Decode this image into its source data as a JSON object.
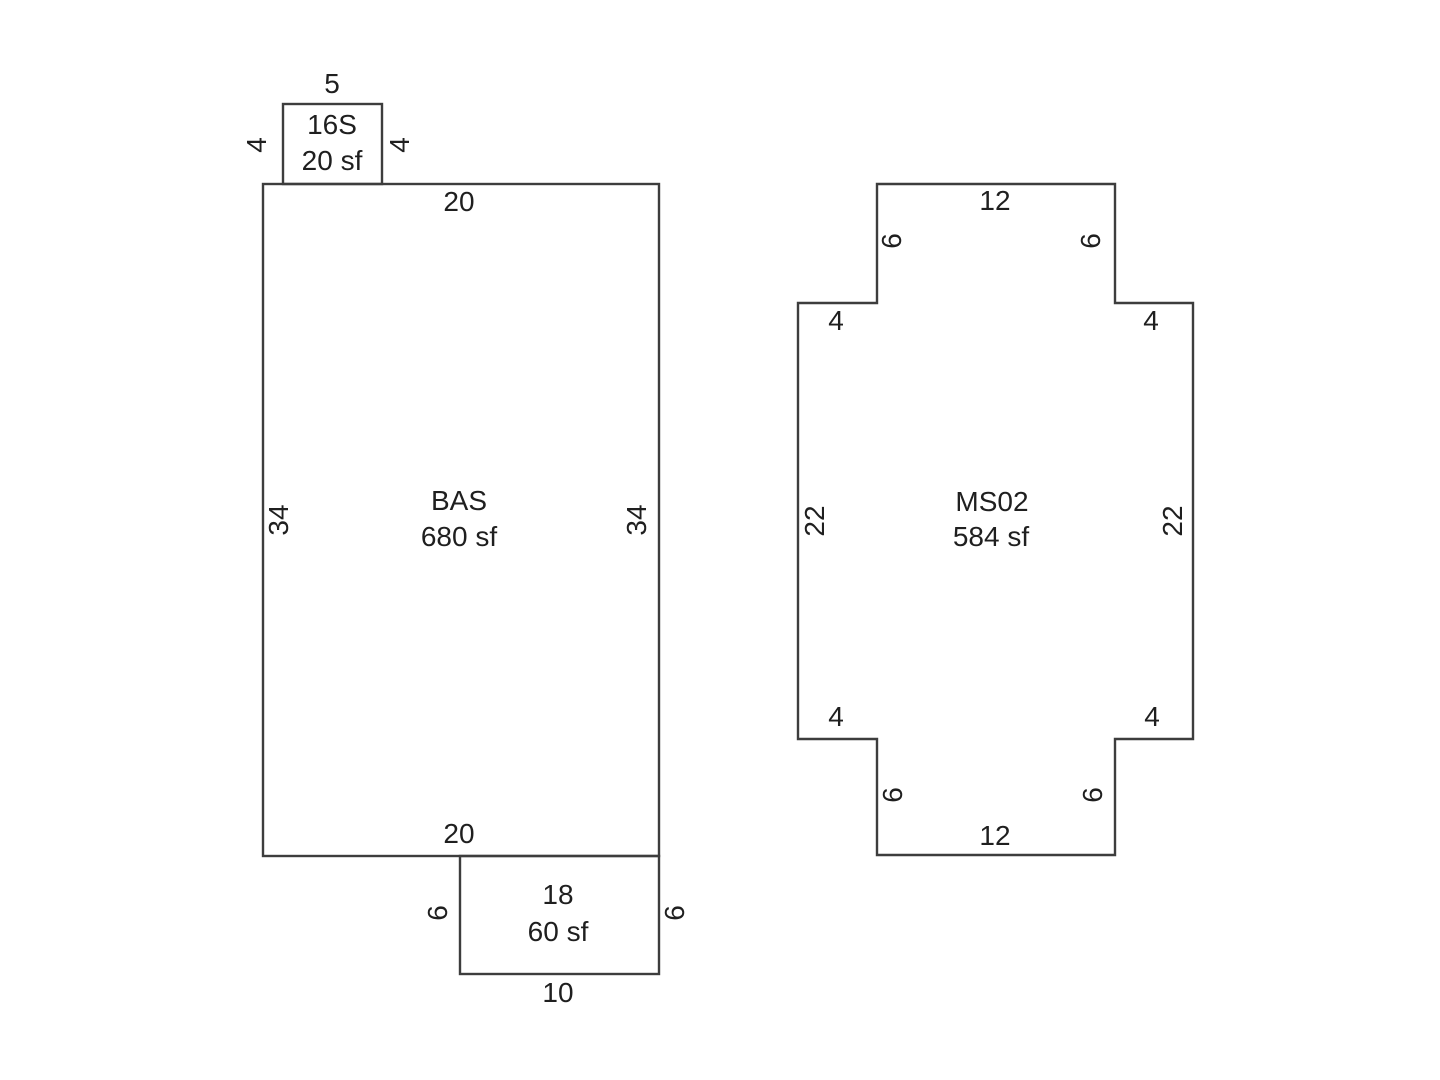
{
  "style": {
    "line_color": "#3d3d3d",
    "text_color": "#1f1f1f",
    "background": "#ffffff"
  },
  "figures": {
    "left": {
      "addition": {
        "name": "16S",
        "area": "20 sf",
        "dim_top": "5",
        "dim_left": "4",
        "dim_right": "4"
      },
      "main": {
        "name": "BAS",
        "area": "680 sf",
        "dim_top": "20",
        "dim_left": "34",
        "dim_right": "34",
        "dim_bottom": "20"
      },
      "porch": {
        "name": "18",
        "area": "60 sf",
        "dim_left": "6",
        "dim_right": "6",
        "dim_bottom": "10"
      }
    },
    "right": {
      "main": {
        "name": "MS02",
        "area": "584 sf",
        "dim_top": "12",
        "dim_top_tab_left": "6",
        "dim_top_tab_right": "6",
        "dim_shoulder_top_left": "4",
        "dim_shoulder_top_right": "4",
        "dim_left": "22",
        "dim_right": "22",
        "dim_shoulder_bottom_left": "4",
        "dim_shoulder_bottom_right": "4",
        "dim_bottom_tab_left": "6",
        "dim_bottom_tab_right": "6",
        "dim_bottom": "12"
      }
    }
  }
}
